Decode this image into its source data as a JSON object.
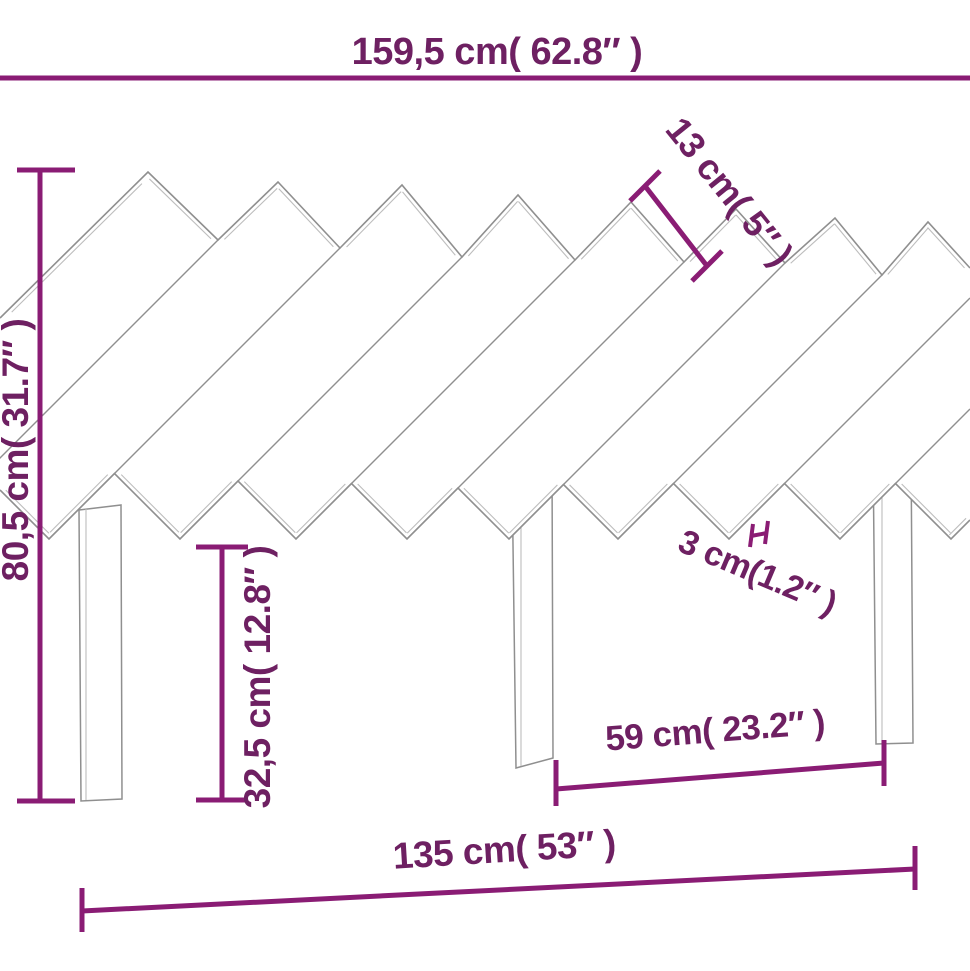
{
  "figure_type": "product-dimension-diagram",
  "product": "wooden slatted headboard with legs",
  "colors": {
    "background": "#ffffff",
    "dim_line": "#8a1c74",
    "dim_text": "#6e2062",
    "outline": "#8f8f8f",
    "outline_light": "#bdbdbd"
  },
  "dimensions": {
    "overall_width": {
      "label": "159,5 cm( 62.8″ )",
      "cm": "159,5",
      "inches": "62.8"
    },
    "overall_height": {
      "label": "80,5 cm( 31.7″ )",
      "cm": "80,5",
      "inches": "31.7"
    },
    "slat_width": {
      "label": "13 cm( 5″ )",
      "cm": "13",
      "inches": "5"
    },
    "leg_height": {
      "label": "32,5 cm( 12.8″ )",
      "cm": "32,5",
      "inches": "12.8"
    },
    "slat_gap": {
      "label": "3 cm(1.2″ )",
      "cm": "3",
      "inches": "1.2"
    },
    "leg_spacing": {
      "label": "59 cm( 23.2″ )",
      "cm": "59",
      "inches": "23.2"
    },
    "base_width": {
      "label": "135 cm( 53″ )",
      "cm": "135",
      "inches": "53"
    }
  }
}
